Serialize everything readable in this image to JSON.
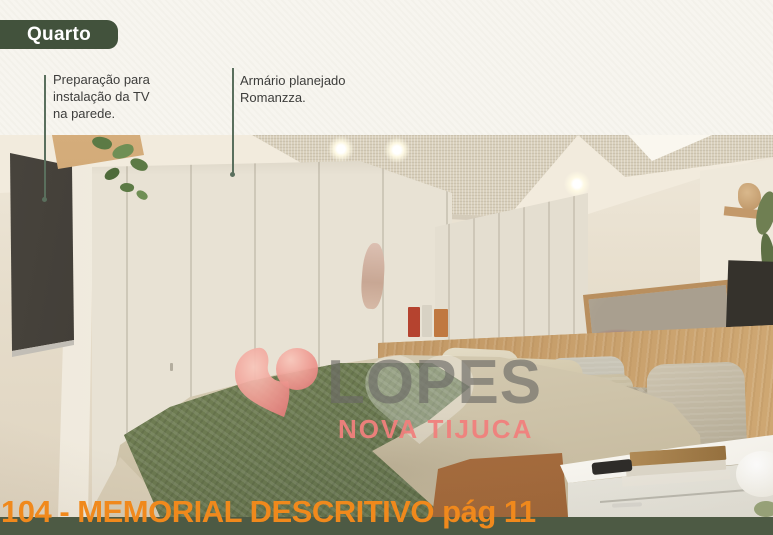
{
  "document": {
    "section_badge": "Quarto",
    "footer_title": "104 - MEMORIAL DESCRITIVO pág 11"
  },
  "annotations": [
    {
      "target": "tv-wall",
      "text": "Preparação para\ninstalação da TV\nna parede."
    },
    {
      "target": "wardrobe",
      "text": "Armário planejado\nRomanzza."
    }
  ],
  "watermark": {
    "brand": "LOPES",
    "location": "NOVA TIJUCA"
  },
  "colors": {
    "badge_green": "#42523c",
    "footer_green": "#4d5a44",
    "leader_green": "#5a6f5d",
    "accent_orange": "#f0891c",
    "watermark_pink": "#ee9a91",
    "watermark_gray": "#6c6a66",
    "throw_green": "#74825a",
    "wood": "#cda471"
  }
}
